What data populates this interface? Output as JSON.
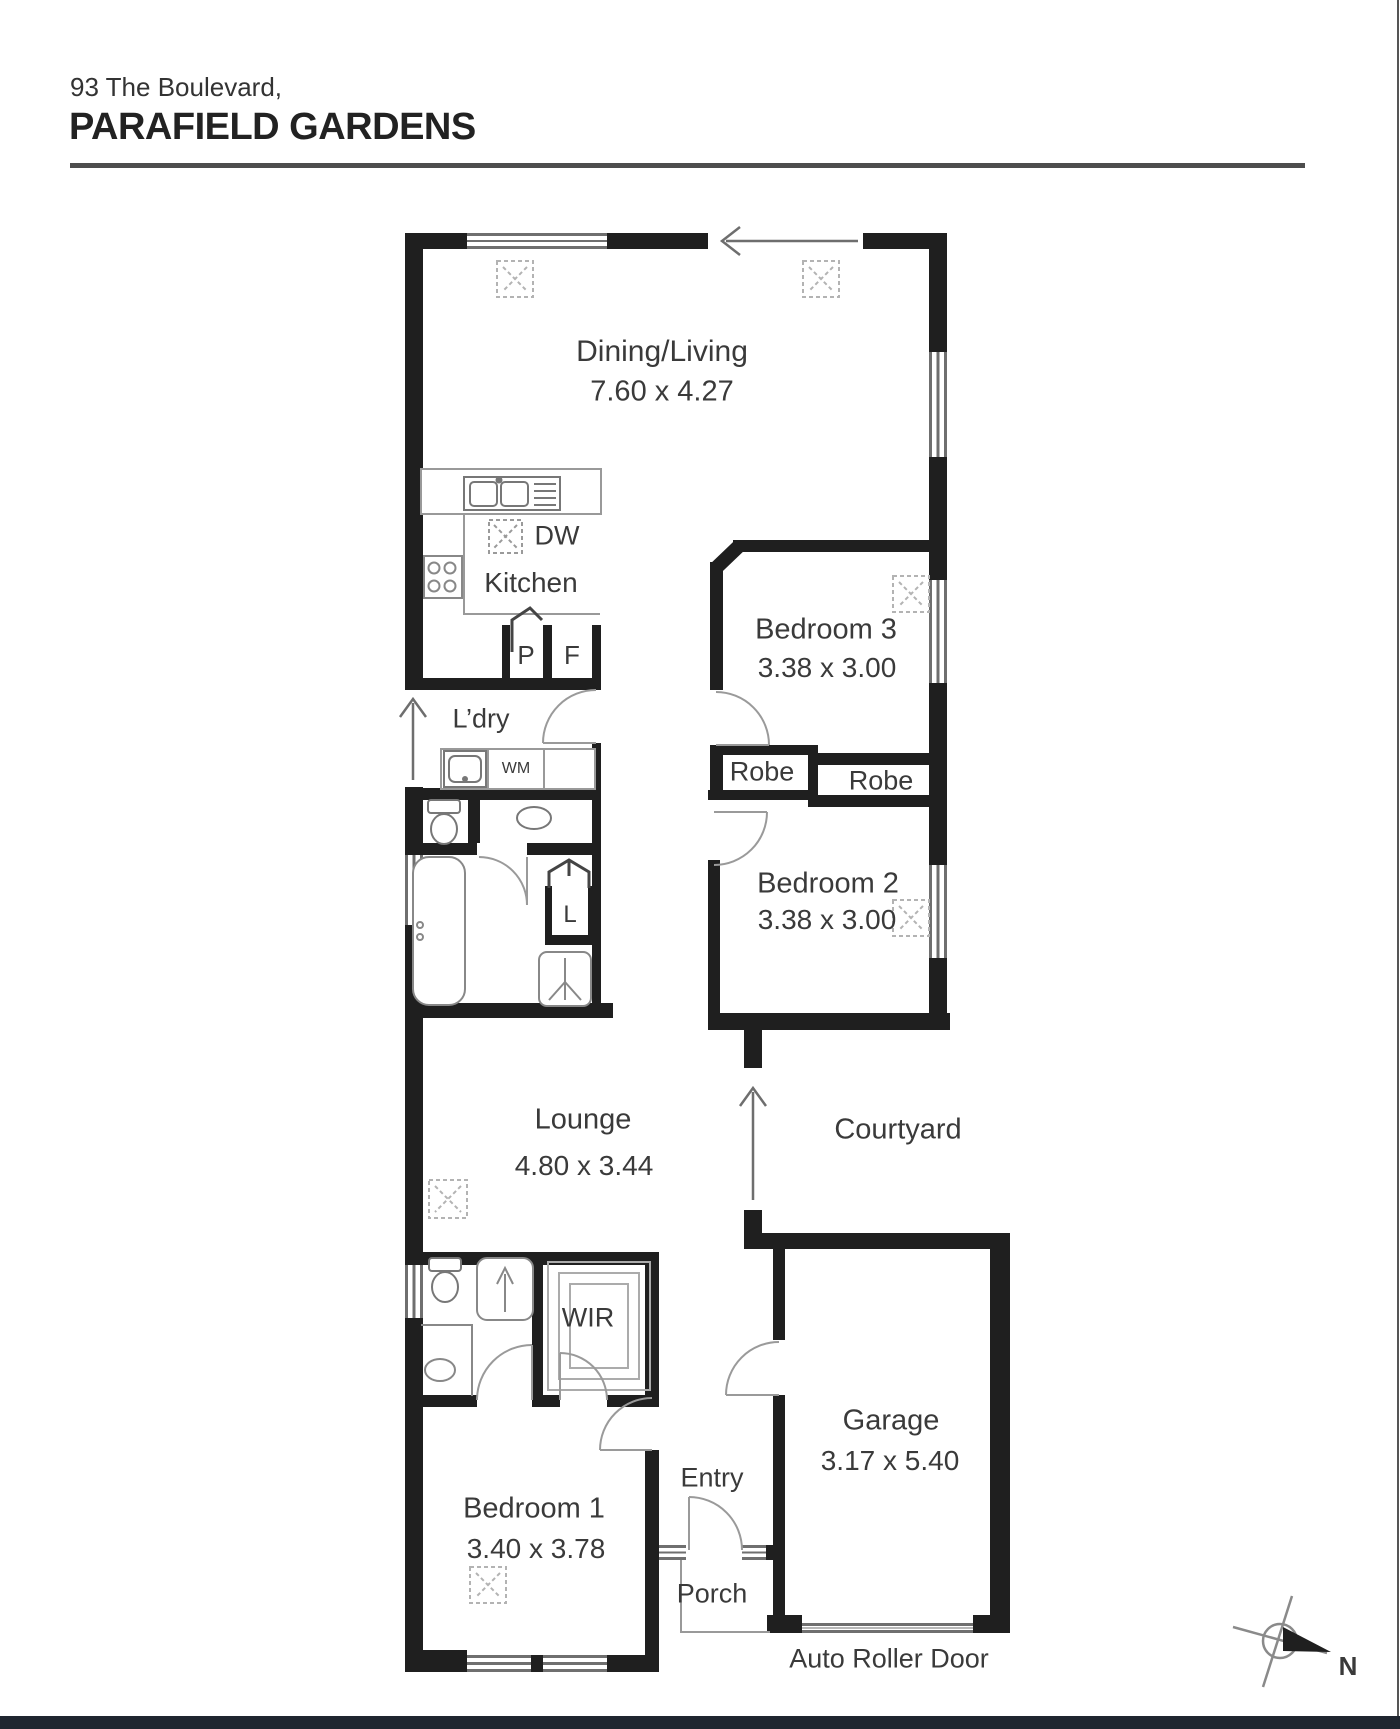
{
  "header": {
    "address_line1": "93 The Boulevard,",
    "address_line2": "PARAFIELD GARDENS"
  },
  "rooms": {
    "dining": {
      "name": "Dining/Living",
      "dims": "7.60 x 4.27"
    },
    "kitchen": {
      "name": "Kitchen"
    },
    "laundry": {
      "name": "L’dry"
    },
    "bed3": {
      "name": "Bedroom 3",
      "dims": "3.38 x 3.00"
    },
    "bed2": {
      "name": "Bedroom 2",
      "dims": "3.38 x 3.00"
    },
    "robe_bed3": {
      "name": "Robe"
    },
    "robe_bed2": {
      "name": "Robe"
    },
    "lounge": {
      "name": "Lounge",
      "dims": "4.80 x 3.44"
    },
    "courtyard": {
      "name": "Courtyard"
    },
    "wir": {
      "name": "WIR"
    },
    "entry": {
      "name": "Entry"
    },
    "porch": {
      "name": "Porch"
    },
    "bed1": {
      "name": "Bedroom 1",
      "dims": "3.40 x 3.78"
    },
    "garage": {
      "name": "Garage",
      "dims": "3.17 x 5.40"
    }
  },
  "fixtures": {
    "dishwasher": "DW",
    "washing_machine": "WM",
    "pantry": "P",
    "fridge": "F",
    "linen": "L"
  },
  "annotations": {
    "roller_door": "Auto Roller Door",
    "north": "N"
  },
  "colors": {
    "wall": "#1f1f1f",
    "fixture_line": "#8c8c8c",
    "text": "#3a3a3a",
    "footer": "#1f2630"
  }
}
